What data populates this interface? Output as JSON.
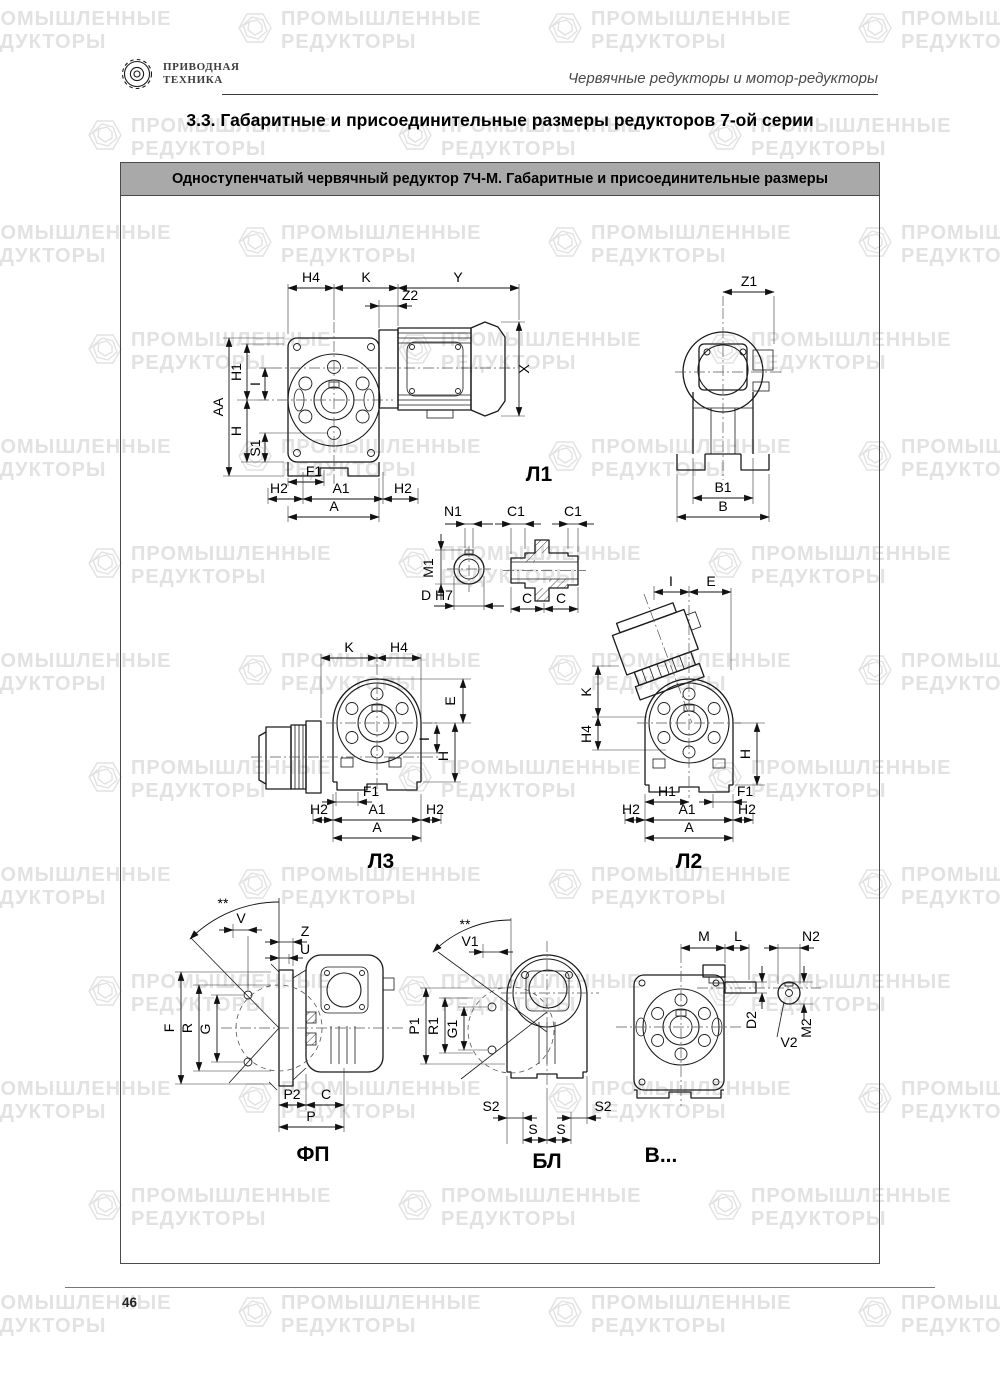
{
  "header": {
    "logo": {
      "line1": "ПРИВОДНАЯ",
      "line2": "ТЕХНИКА"
    },
    "tagline": "Червячные редукторы и мотор-редукторы"
  },
  "section_title": "3.3. Габаритные и присоединительные размеры редукторов 7-ой серии",
  "panel": {
    "title": "Одноступенчатый червячный редуктор 7Ч-М. Габаритные и присоединительные размеры"
  },
  "watermark": {
    "line1": "ПРОМЫШЛЕННЫЕ",
    "line2": "РЕДУКТОРЫ"
  },
  "footer": {
    "page_number": "46"
  },
  "drawings": {
    "l1": {
      "label": "Л1",
      "h4": "H4",
      "k": "K",
      "y": "Y",
      "z2": "Z2",
      "x": "X",
      "aa": "AA",
      "h1": "H1",
      "i": "I",
      "h": "H",
      "s1": "S1",
      "f1": "F1",
      "h2_left": "H2",
      "a1": "A1",
      "h2_right": "H2",
      "a": "A"
    },
    "rear": {
      "z1": "Z1",
      "b1": "B1",
      "b": "B"
    },
    "bore": {
      "n1": "N1",
      "m1": "M1",
      "d": "D H7"
    },
    "shaft": {
      "c1_left": "C1",
      "c1_right": "C1",
      "c_left": "C",
      "c_right": "C"
    },
    "l3": {
      "label": "Л3",
      "k": "K",
      "h4": "H4",
      "e": "E",
      "i": "I",
      "h": "H",
      "f1": "F1",
      "h2_left": "H2",
      "a1": "A1",
      "h2_right": "H2",
      "a": "A"
    },
    "l2": {
      "label": "Л2",
      "i": "I",
      "e": "E",
      "k": "K",
      "h4": "H4",
      "h": "H",
      "h1": "H1",
      "f1": "F1",
      "h2_left": "H2",
      "a1": "A1",
      "h2_right": "H2",
      "a": "A"
    },
    "fp": {
      "label": "ФП",
      "stars": "**",
      "v": "V",
      "z": "Z",
      "u": "U",
      "f": "F",
      "r": "R",
      "g": "G",
      "p2": "P2",
      "c": "C",
      "p": "P"
    },
    "bl": {
      "label": "БЛ",
      "stars": "**",
      "v1": "V1",
      "p1": "P1",
      "r1": "R1",
      "g1": "G1",
      "s2_left": "S2",
      "s2_right": "S2",
      "s_left": "S",
      "s_right": "S"
    },
    "v": {
      "label": "В...",
      "m": "M",
      "l": "L",
      "n2": "N2",
      "d2": "D2",
      "m2": "M2",
      "v2": "V2"
    }
  }
}
